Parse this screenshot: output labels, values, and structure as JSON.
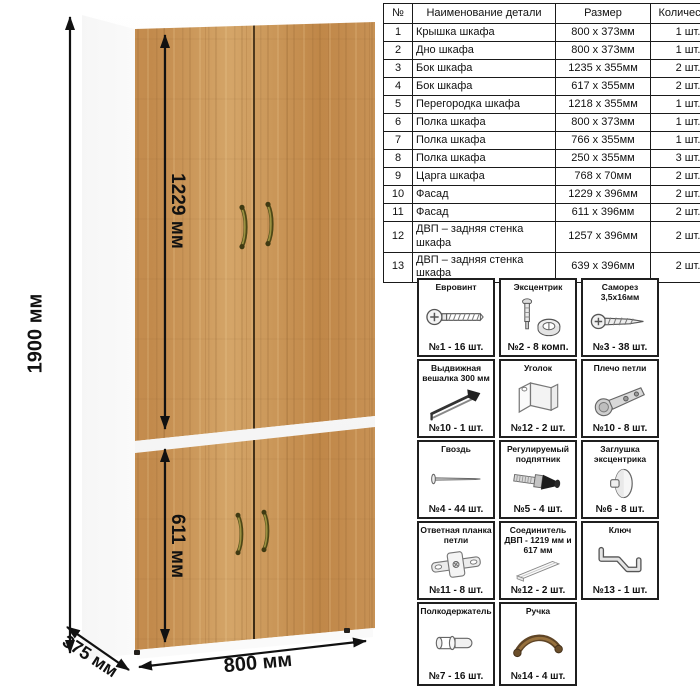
{
  "dimensions": {
    "height": "1900 мм",
    "upper_facade_height": "1229 мм",
    "lower_facade_height": "611 мм",
    "width": "800 мм",
    "depth": "375 мм"
  },
  "parts_table": {
    "headers": [
      "№",
      "Наименование детали",
      "Размер",
      "Количество"
    ],
    "rows": [
      [
        "1",
        "Крышка шкафа",
        "800 х 373мм",
        "1 шт."
      ],
      [
        "2",
        "Дно шкафа",
        "800 х 373мм",
        "1 шт."
      ],
      [
        "3",
        "Бок шкафа",
        "1235 х 355мм",
        "2 шт."
      ],
      [
        "4",
        "Бок шкафа",
        "617 х 355мм",
        "2 шт."
      ],
      [
        "5",
        "Перегородка шкафа",
        "1218 х 355мм",
        "1 шт."
      ],
      [
        "6",
        "Полка шкафа",
        "800 х 373мм",
        "1 шт."
      ],
      [
        "7",
        "Полка шкафа",
        "766 х 355мм",
        "1 шт."
      ],
      [
        "8",
        "Полка шкафа",
        "250 х 355мм",
        "3 шт."
      ],
      [
        "9",
        "Царга шкафа",
        "768 х 70мм",
        "2 шт."
      ],
      [
        "10",
        "Фасад",
        "1229 х 396мм",
        "2 шт."
      ],
      [
        "11",
        "Фасад",
        "611 х 396мм",
        "2 шт."
      ],
      [
        "12",
        "ДВП – задняя стенка шкафа",
        "1257 х 396мм",
        "2 шт."
      ],
      [
        "13",
        "ДВП – задняя стенка шкафа",
        "639 х 396мм",
        "2 шт."
      ]
    ]
  },
  "hardware": {
    "items": [
      {
        "name": "Евровинт",
        "count": "№1 - 16 шт."
      },
      {
        "name": "Эксцентрик",
        "count": "№2 - 8 комп."
      },
      {
        "name": "Саморез 3,5х16мм",
        "count": "№3 - 38 шт."
      },
      {
        "name": "Выдвижная вешалка 300 мм",
        "count": "№10 - 1 шт."
      },
      {
        "name": "Уголок",
        "count": "№12 - 2 шт."
      },
      {
        "name": "Плечо петли",
        "count": "№10 - 8 шт."
      },
      {
        "name": "Гвоздь",
        "count": "№4 - 44 шт."
      },
      {
        "name": "Регулируемый подпятник",
        "count": "№5 - 4 шт."
      },
      {
        "name": "Заглушка эксцентрика",
        "count": "№6 - 8 шт."
      },
      {
        "name": "Ответная планка петли",
        "count": "№11 - 8 шт."
      },
      {
        "name": "Соединитель ДВП - 1219 мм и 617 мм",
        "count": "№12 - 2 шт."
      },
      {
        "name": "Ключ",
        "count": "№13 - 1 шт."
      },
      {
        "name": "Полкодержатель",
        "count": "№7 - 16 шт."
      },
      {
        "name": "Ручка",
        "count": "№14 - 4 шт."
      }
    ]
  },
  "colors": {
    "wood_base": "#c6905a",
    "wood_dark": "#a8703a",
    "wood_light": "#d4a568",
    "carcass_white": "#fcfcfc",
    "handle_bronze": "#7d7530",
    "line_black": "#111111"
  }
}
